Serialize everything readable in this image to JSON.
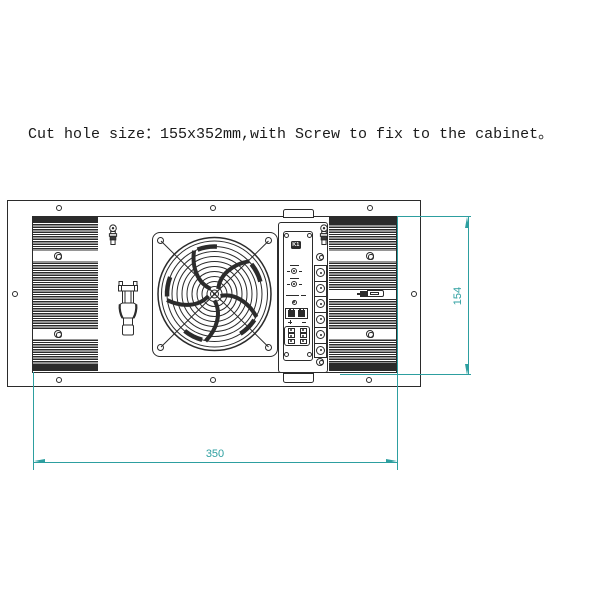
{
  "note": {
    "text": "Cut hole size：155x352mm,with Screw to fix to the cabinet。"
  },
  "drawing": {
    "dimensions": {
      "width_mm": "350",
      "height_mm": "154"
    },
    "labels": {
      "relay": "K1"
    },
    "colors": {
      "dimension_teal": "#2d9fa0",
      "line_ink": "#2b2b2b"
    },
    "icons": [
      "fan-guard-icon",
      "bolt-icon",
      "cable-clip-icon",
      "screw-icon",
      "terminal-screw-icon",
      "mounting-hole"
    ]
  }
}
